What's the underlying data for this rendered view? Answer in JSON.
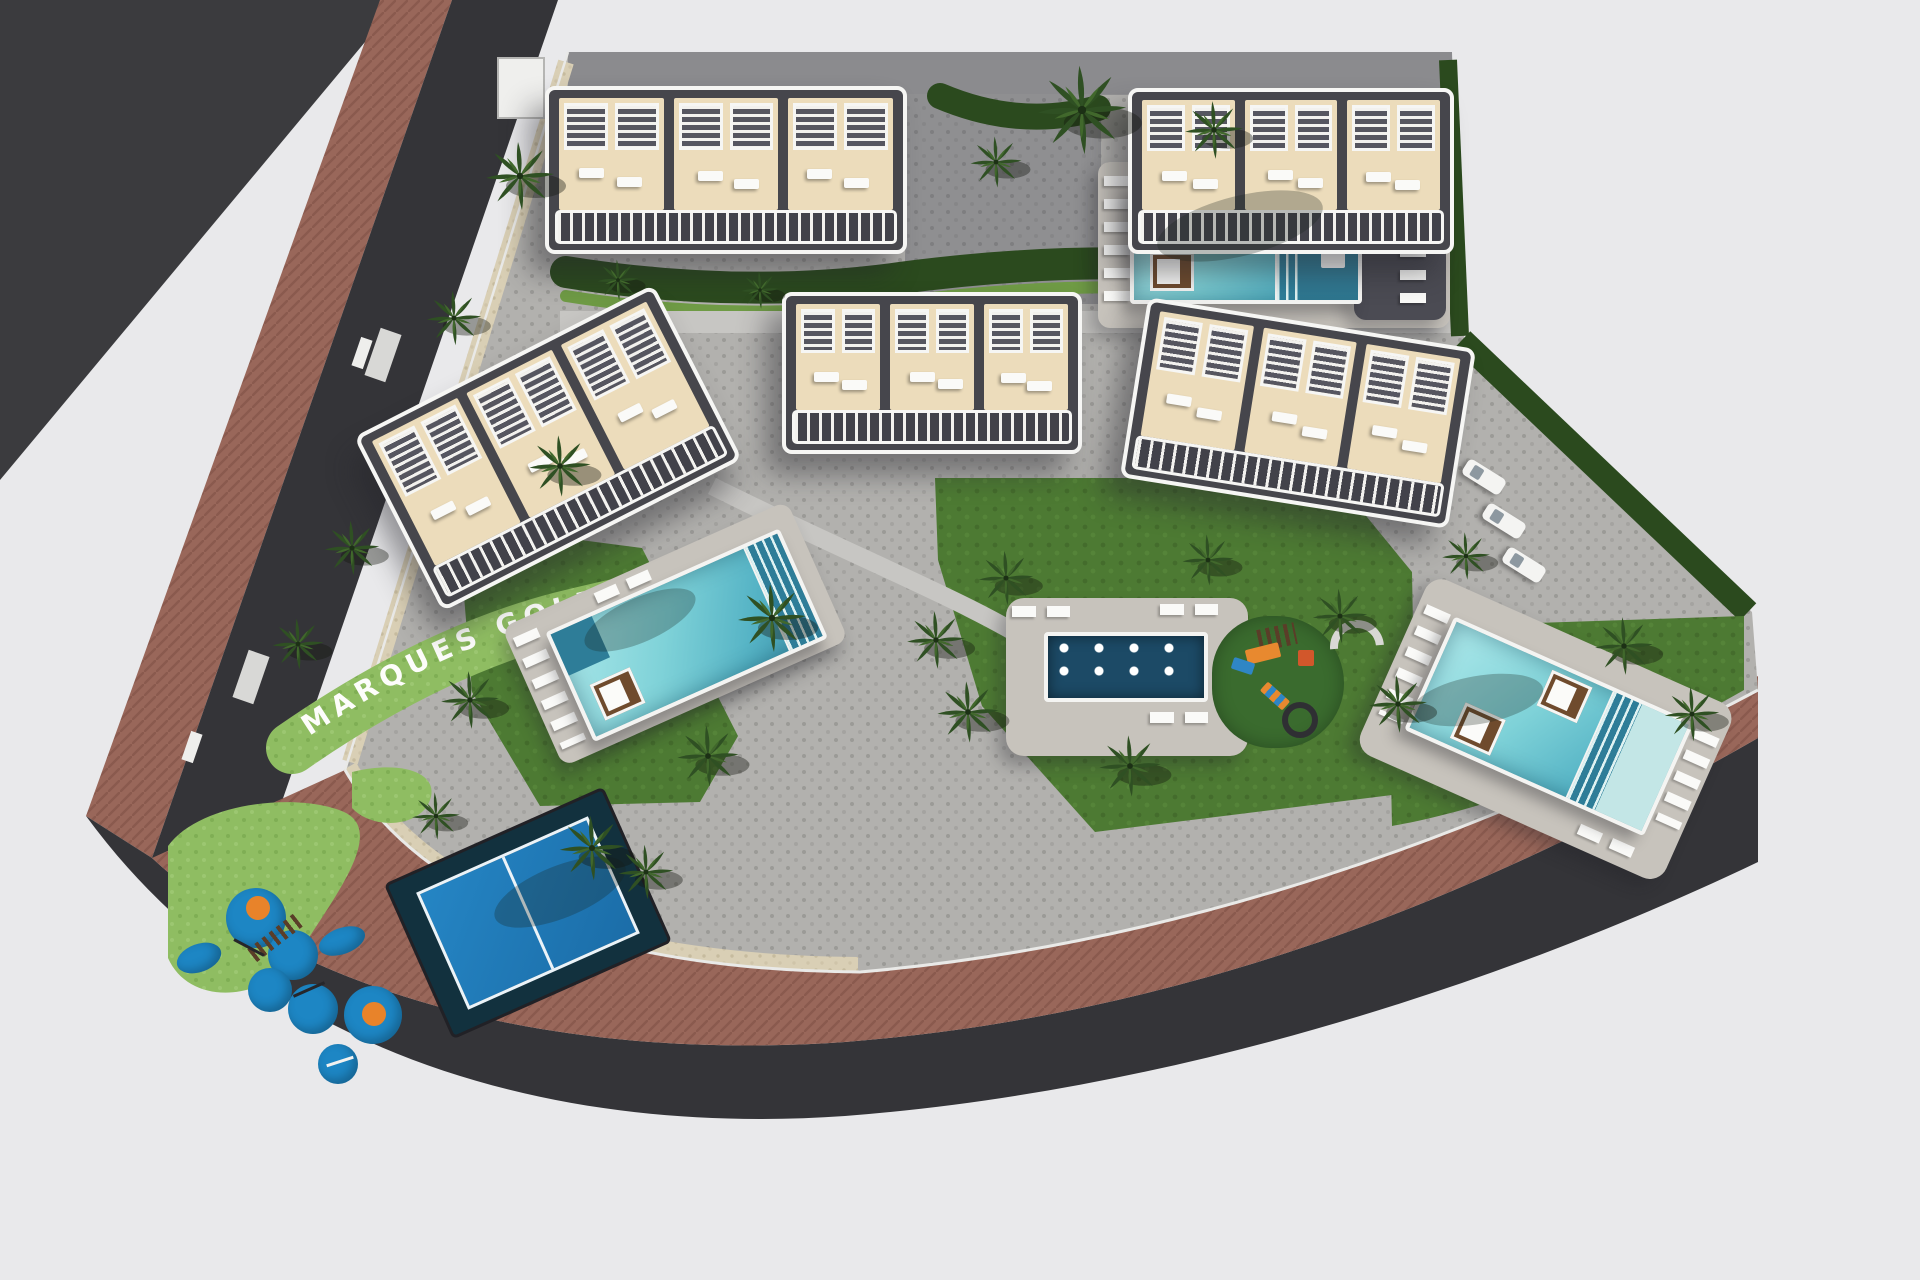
{
  "scene": {
    "type": "aerial-3d-site-plan-render",
    "road_label": "MARQUES GOLF"
  },
  "legend": {
    "buildings": "five townhouse blocks with rooftop pergolas, sun terraces and balcony rows",
    "pools": [
      "north communal pool",
      "west lagoon pool",
      "central splash pool with water jets",
      "east lagoon pool"
    ],
    "amenities": [
      "padel court",
      "west children playground",
      "central children playground",
      "street parking",
      "palm garden"
    ]
  },
  "palette": {
    "background": "#e9e9eb",
    "asphalt_road": "#343438",
    "brick_sidewalk": "#99675a",
    "pavers_light": "#b2b1ae",
    "pavers_dark": "#8f8f91",
    "lawn": "#4d7a33",
    "bright_lawn": "#8fbd62",
    "hedge": "#2b4a1e",
    "gravel": "#d9cfb5",
    "pool_water": "#7fd2d8",
    "pool_steps": "#2e7d98",
    "splash_pool": "#1c4a66",
    "padel_court_blue": "#1f78b5",
    "playground_rubber_blue": "#1d86c4",
    "playground_orange": "#e8832a",
    "building_roof_cream": "#ecdcbb",
    "building_trim_white": "#f6f6f4",
    "sign_text": "#fdfdfb"
  }
}
